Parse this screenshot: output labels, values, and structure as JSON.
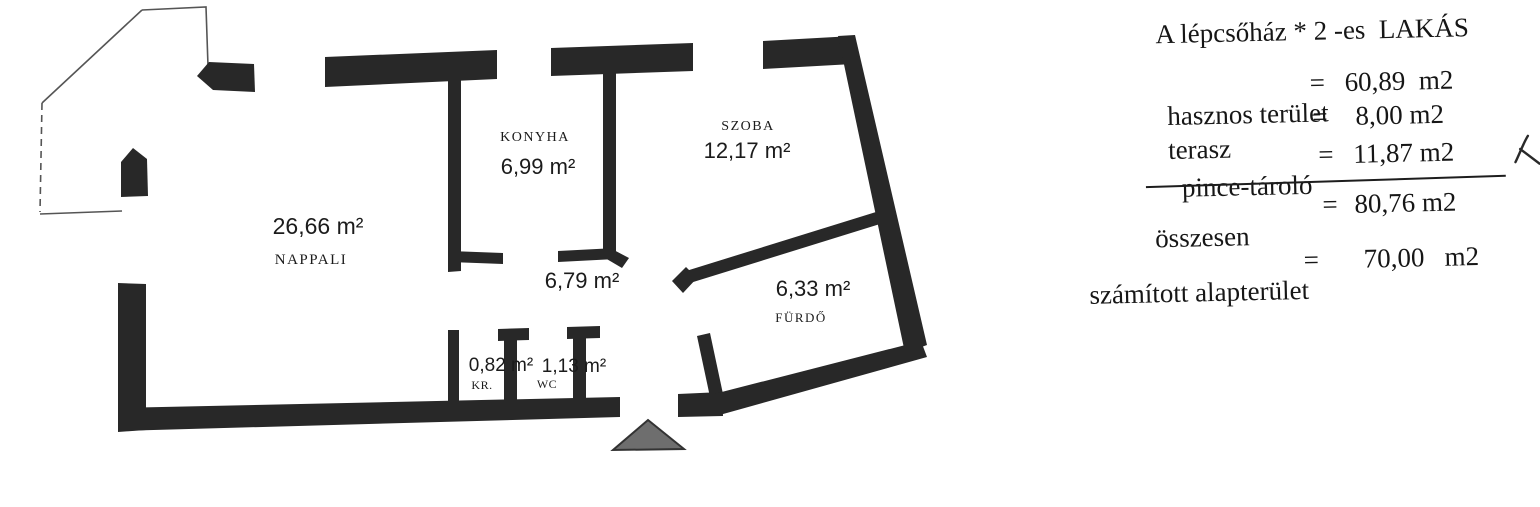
{
  "document_type": "scanned apartment floor plan",
  "rooms": {
    "nappali": {
      "name": "NAPPALI",
      "area": "26,66 m²"
    },
    "konyha": {
      "name": "KONYHA",
      "area": "6,99 m²"
    },
    "szoba": {
      "name": "SZOBA",
      "area": "12,17 m²"
    },
    "eloter": {
      "area": "6,79 m²"
    },
    "furdo": {
      "name": "FÜRDŐ",
      "area": "6,33 m²"
    },
    "kamra": {
      "name": "KR.",
      "area": "0,82 m²"
    },
    "wc": {
      "name": "WC",
      "area": "1,13 m²"
    }
  },
  "summary": {
    "title": "A lépcsőház * 2 -es  LAKÁS",
    "rows": [
      {
        "label": "hasznos terület",
        "eq": "=",
        "value": "60,89  m2"
      },
      {
        "label": "terasz",
        "eq": "=",
        "value": "8,00 m2"
      },
      {
        "label": "pince-tároló",
        "eq": "=",
        "value": "11,87 m2"
      },
      {
        "label": "összesen",
        "eq": "=",
        "value": "80,76 m2"
      }
    ],
    "footer": {
      "label": "számított alapterület",
      "eq": "=",
      "value": "70,00   m2"
    }
  },
  "markers": {
    "entrance": "gray triangle arrow at main entry",
    "handwritten_check": "small pen mark after pince-tároló value"
  },
  "colors": {
    "wall": "#282828",
    "entrance_triangle_fill": "#6e6e6e",
    "entrance_triangle_stroke": "#333333",
    "thin_outline": "#555555",
    "text": "#161616",
    "background": "#ffffff"
  }
}
